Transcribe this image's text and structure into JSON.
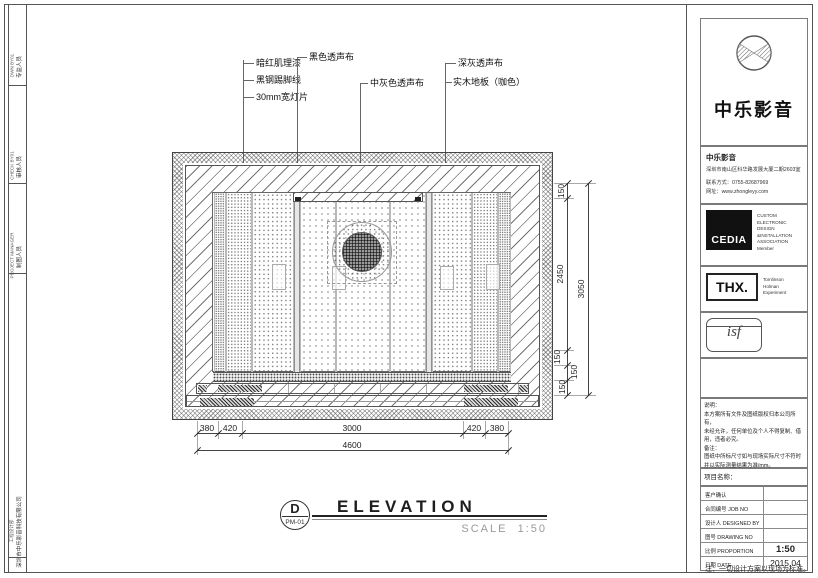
{
  "left_strip": {
    "groups": [
      {
        "label": "专监人员",
        "sub": "DWN BY01"
      },
      {
        "label": "审核人员",
        "sub": "CHECK BY01"
      },
      {
        "label": "制图人员",
        "sub": "PROJECT MANAGER"
      },
      {
        "label": "深圳市中乐影音科技有限公司",
        "sub": "工程设计部"
      }
    ]
  },
  "materials": {
    "labels": [
      {
        "text": "暗红肌理漆"
      },
      {
        "text": "黑钢踢脚线"
      },
      {
        "text": "30mm宽灯片"
      },
      {
        "text": "黑色透声布"
      },
      {
        "text": "中灰色透声布"
      },
      {
        "text": "深灰透声布"
      },
      {
        "text": "实木地板（咖色）"
      }
    ]
  },
  "dimensions": {
    "bottom": {
      "segments": [
        "380",
        "420",
        "3000",
        "420",
        "380"
      ],
      "total": "4600"
    },
    "right": {
      "segments": [
        "150",
        "2450",
        "150",
        "150",
        "150"
      ],
      "total": "3050"
    }
  },
  "view_title": {
    "letter": "D",
    "code": "PM-01",
    "title": "ELEVATION",
    "scale_label": "SCALE",
    "scale_value": "1:50"
  },
  "titleblock": {
    "brand": {
      "name": "中乐影音"
    },
    "company": {
      "name": "中乐影音",
      "address": "深圳市南山区科华路发展大厦二期2603室",
      "phone": "联系方式：0755-82687969",
      "website": "网址：www.zhongleyy.com"
    },
    "cedia": {
      "logo": "CEDIA",
      "line1": "CUSTOM ELECTRONIC",
      "line2": "DESIGN &INSTALLATION",
      "line3": "ASSOCIATION",
      "line4": "Member"
    },
    "thx": {
      "logo": "THX.",
      "line1": "Tomlinson",
      "line2": "Holman",
      "line3": "Experiment"
    },
    "isf": {
      "logo": "isf"
    },
    "notes": {
      "l1": "说明：",
      "l2": "本方案所有文件及图纸版权归本公司所有，",
      "l3": "未经允许，任何单位及个人不得复制、借",
      "l4": "用，违者必究。",
      "l5": "备注：",
      "l6": "图纸中所标尺寸如与现场实际尺寸不符时",
      "l7": "并以实际测量结果为准/mm。"
    },
    "project_label": "项目名称：",
    "rows": [
      {
        "zh": "客户确认",
        "en": "",
        "value": ""
      },
      {
        "zh": "合同编号",
        "en": "JOB NO",
        "value": ""
      },
      {
        "zh": "设计人",
        "en": "DESIGNED BY",
        "value": ""
      },
      {
        "zh": "图号",
        "en": "DRAWING NO",
        "value": ""
      },
      {
        "zh": "比例",
        "en": "PROPORTION",
        "value": "1:50"
      },
      {
        "zh": "日期",
        "en": "DATE",
        "value": "2015.04"
      }
    ],
    "footnote": "注：一切设计方案以现场为标准。"
  }
}
